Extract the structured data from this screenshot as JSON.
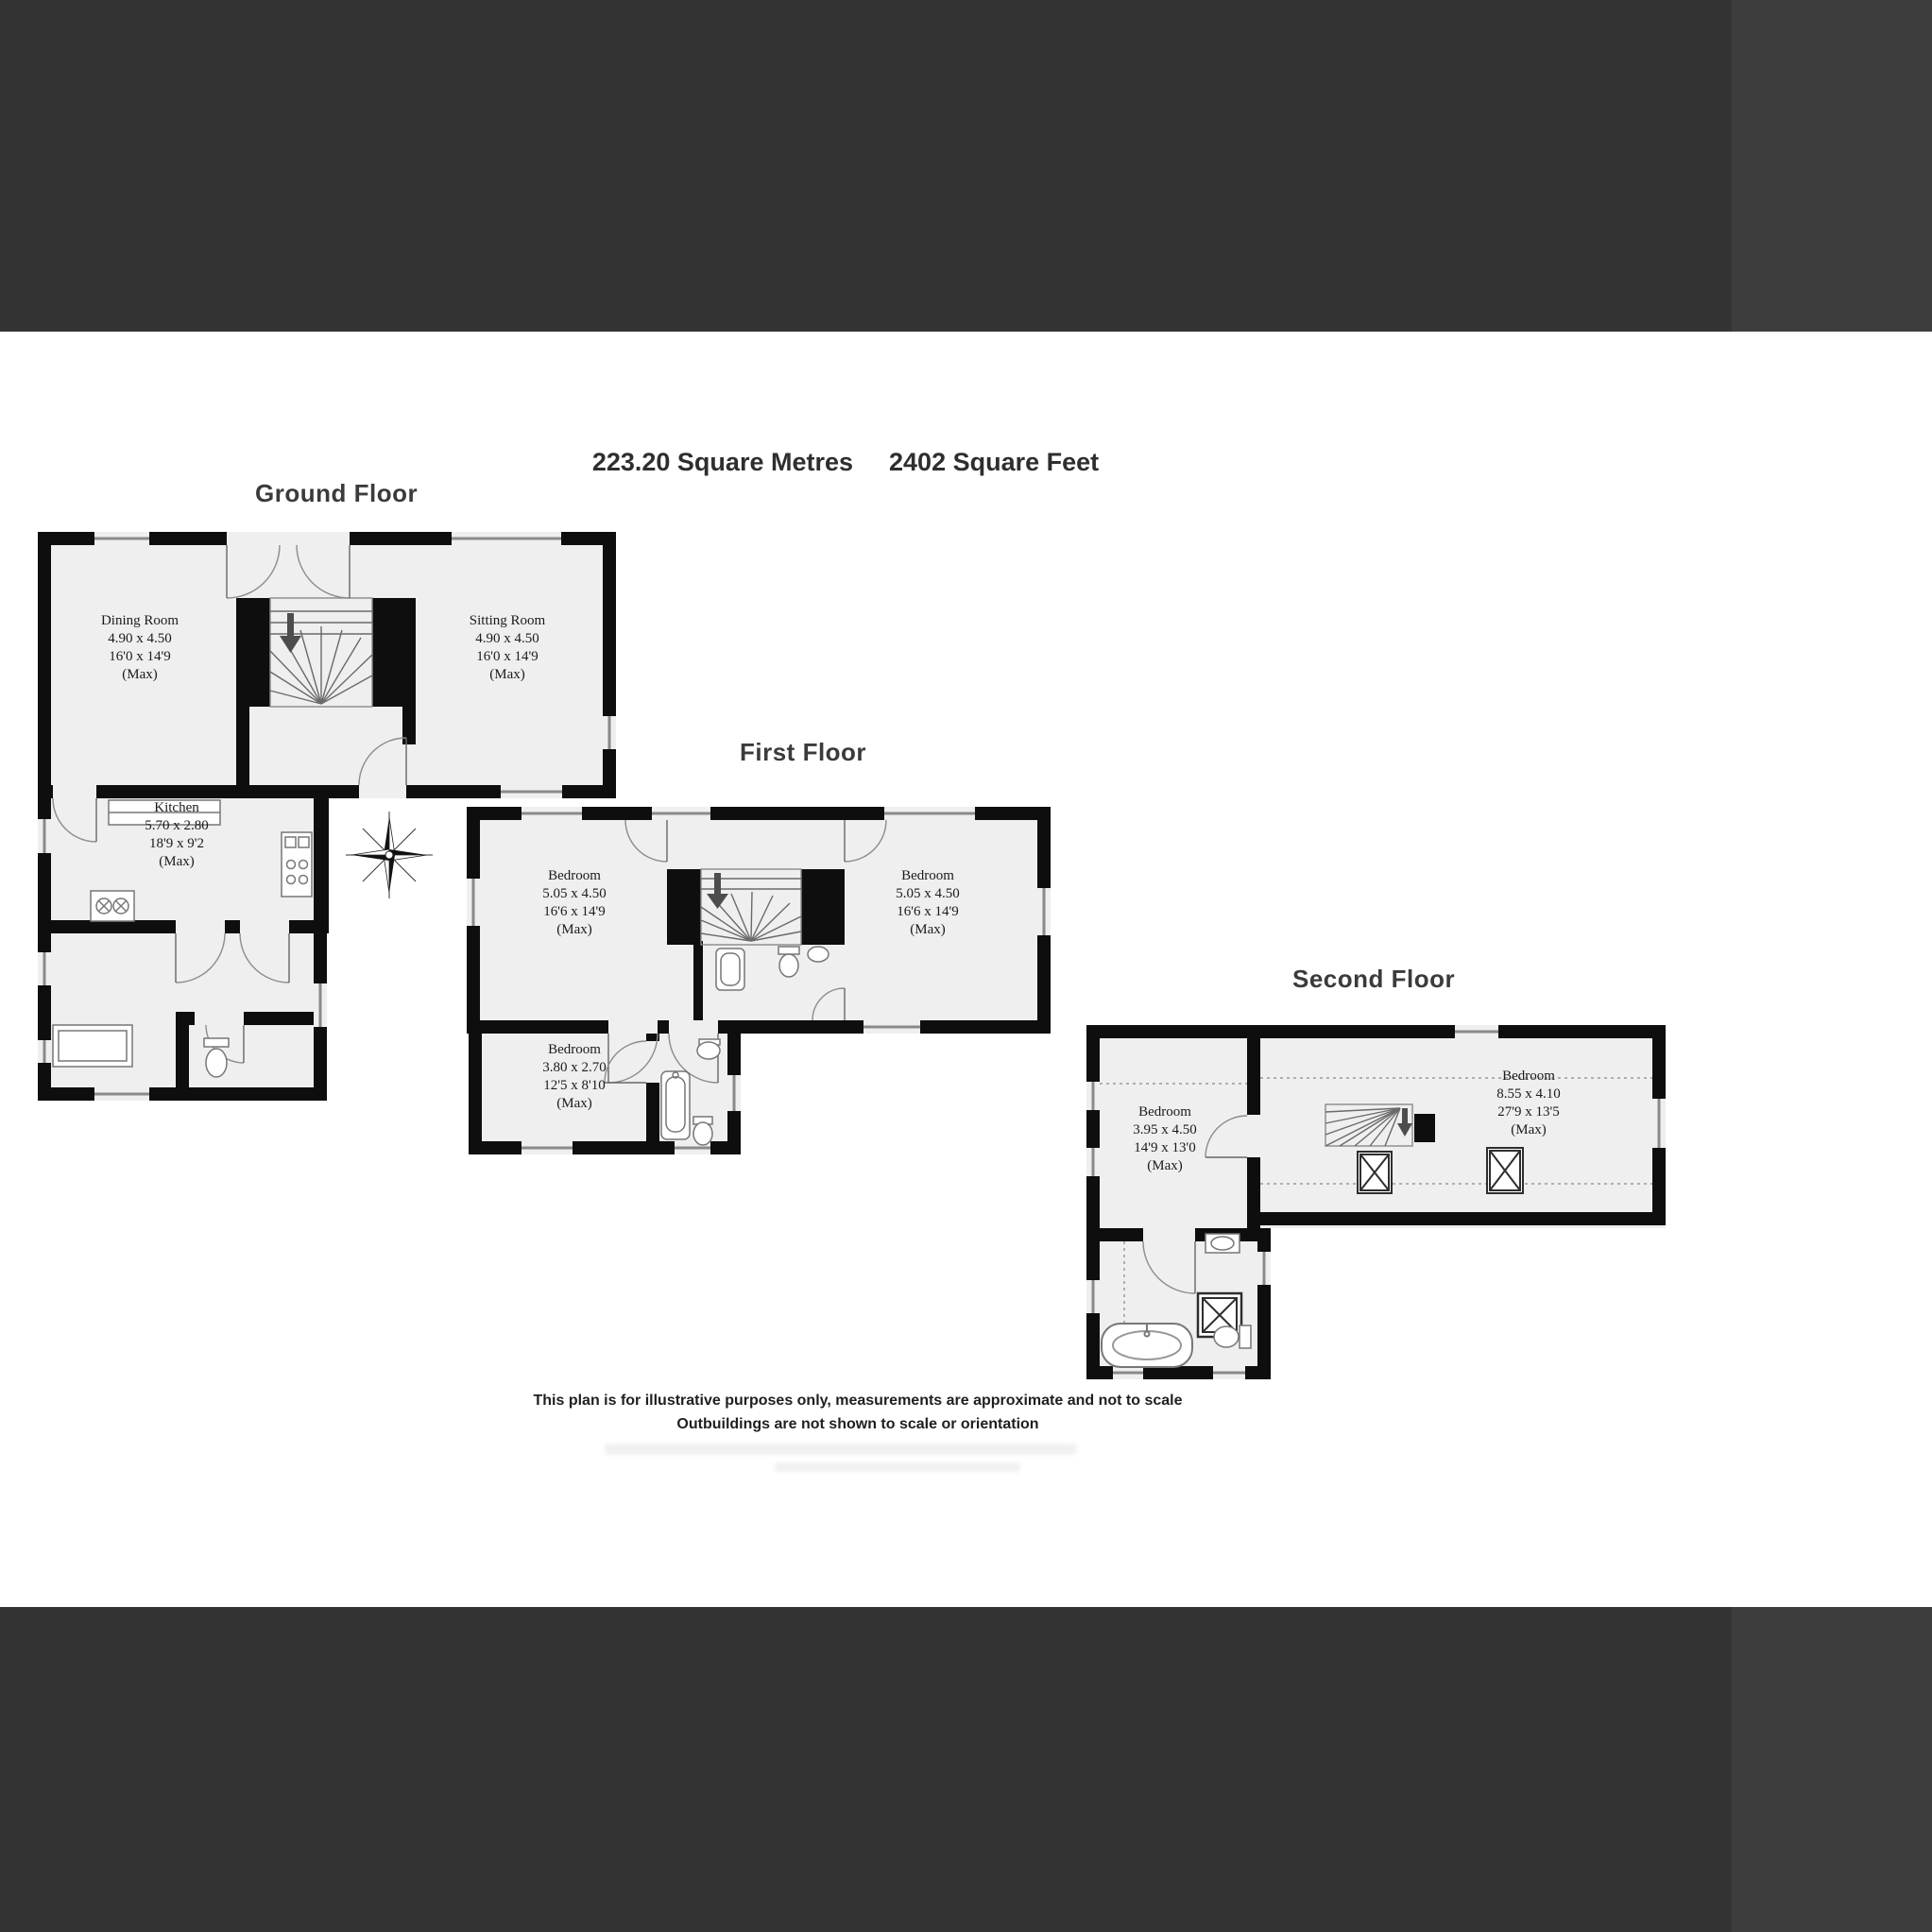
{
  "theme": {
    "bar_dark": "#333333",
    "bar_light": "#3d3d3d",
    "wall": "#0e0e0e",
    "room_fill": "#efefef",
    "window_line": "#8a8a8a"
  },
  "header": {
    "area_metric": "223.20 Square Metres",
    "area_imperial": "2402 Square Feet"
  },
  "floors": [
    {
      "title": "Ground Floor",
      "rooms": [
        {
          "name": "Dining Room",
          "metric": "4.90 x 4.50",
          "imperial": "16'0 x 14'9",
          "qualifier": "(Max)"
        },
        {
          "name": "Sitting Room",
          "metric": "4.90 x 4.50",
          "imperial": "16'0 x 14'9",
          "qualifier": "(Max)"
        },
        {
          "name": "Kitchen",
          "metric": "5.70 x 2.80",
          "imperial": "18'9 x 9'2",
          "qualifier": "(Max)"
        }
      ]
    },
    {
      "title": "First Floor",
      "rooms": [
        {
          "name": "Bedroom",
          "metric": "5.05 x 4.50",
          "imperial": "16'6 x 14'9",
          "qualifier": "(Max)"
        },
        {
          "name": "Bedroom",
          "metric": "5.05 x 4.50",
          "imperial": "16'6 x 14'9",
          "qualifier": "(Max)"
        },
        {
          "name": "Bedroom",
          "metric": "3.80 x 2.70",
          "imperial": "12'5 x 8'10",
          "qualifier": "(Max)"
        }
      ]
    },
    {
      "title": "Second Floor",
      "rooms": [
        {
          "name": "Bedroom",
          "metric": "3.95 x 4.50",
          "imperial": "14'9 x 13'0",
          "qualifier": "(Max)"
        },
        {
          "name": "Bedroom",
          "metric": "8.55 x 4.10",
          "imperial": "27'9 x 13'5",
          "qualifier": "(Max)"
        }
      ]
    }
  ],
  "disclaimer": {
    "line1": "This plan is for illustrative purposes only, measurements are approximate and not to scale",
    "line2": "Outbuildings are not shown to scale or orientation"
  },
  "icons": {
    "compass": "compass-rose-icon",
    "stairs_arrow": "stairs-down-arrow-icon",
    "skylight": "crossed-box-window-icon"
  }
}
